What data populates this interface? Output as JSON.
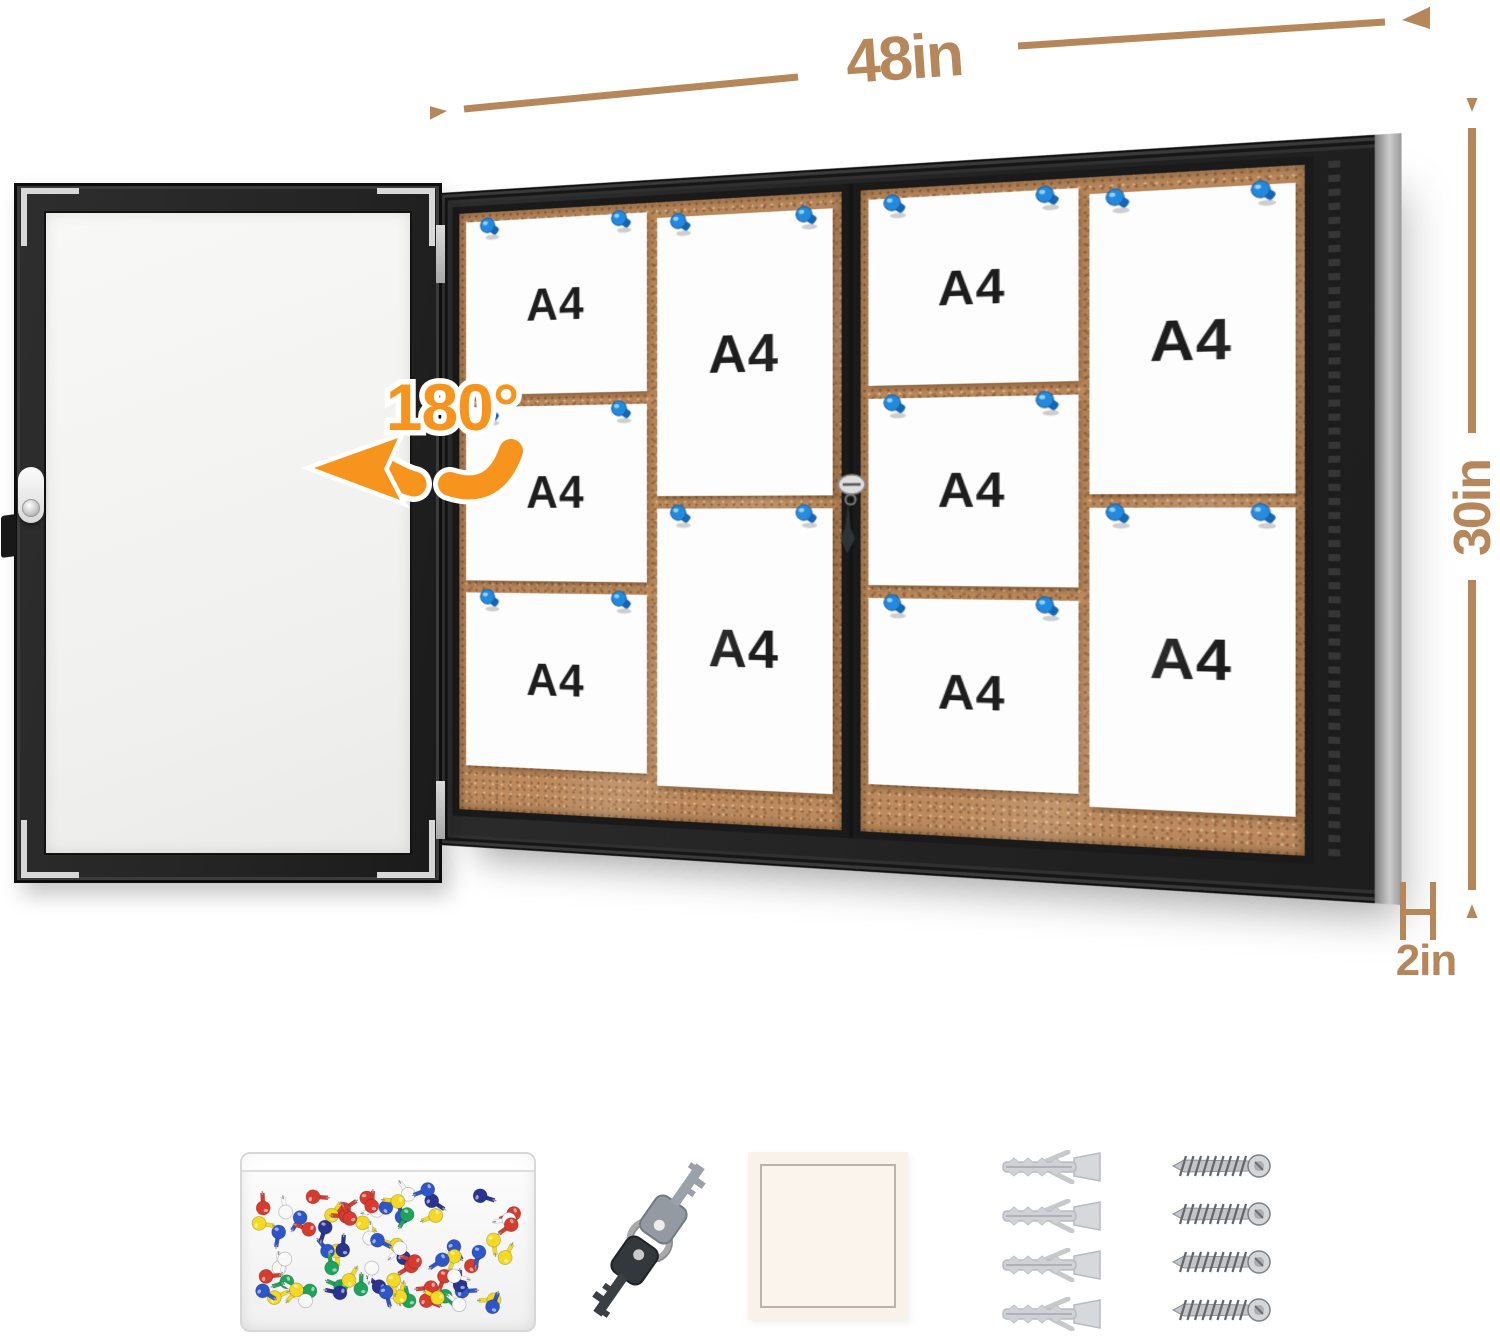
{
  "annotations": {
    "width_label": "48in",
    "height_label": "30in",
    "depth_label": "2in",
    "rotation_label": "180°"
  },
  "board": {
    "panels": [
      {
        "name": "left-sliding-door-panel",
        "papers": [
          {
            "label": "A4",
            "orientation": "landscape"
          },
          {
            "label": "A4",
            "orientation": "landscape"
          },
          {
            "label": "A4",
            "orientation": "landscape"
          },
          {
            "label": "A4",
            "orientation": "portrait"
          },
          {
            "label": "A4",
            "orientation": "portrait"
          }
        ]
      },
      {
        "name": "right-sliding-door-panel",
        "papers": [
          {
            "label": "A4",
            "orientation": "landscape"
          },
          {
            "label": "A4",
            "orientation": "landscape"
          },
          {
            "label": "A4",
            "orientation": "landscape"
          },
          {
            "label": "A4",
            "orientation": "portrait"
          },
          {
            "label": "A4",
            "orientation": "portrait"
          }
        ]
      }
    ],
    "pins_per_paper": 2
  },
  "accessories": {
    "pin_box": {
      "name": "push-pin-box",
      "pin_count": 78,
      "pin_colors": [
        "#d63b2f",
        "#28348f",
        "#1ea35b",
        "#f5d820",
        "#f8f8f8",
        "#2f56c9"
      ]
    },
    "keys": {
      "name": "lock-keys",
      "count": 2
    },
    "card": {
      "name": "blank-card"
    },
    "anchors": {
      "name": "wall-anchors",
      "count": 4
    },
    "screws": {
      "name": "mounting-screws",
      "count": 4
    }
  },
  "colors": {
    "dimension_text": "#b5875a",
    "rotation_accent": "#f7941e",
    "cork": "#bc8a5d",
    "frame_black": "#232323",
    "pin_blue": "#2289de"
  }
}
